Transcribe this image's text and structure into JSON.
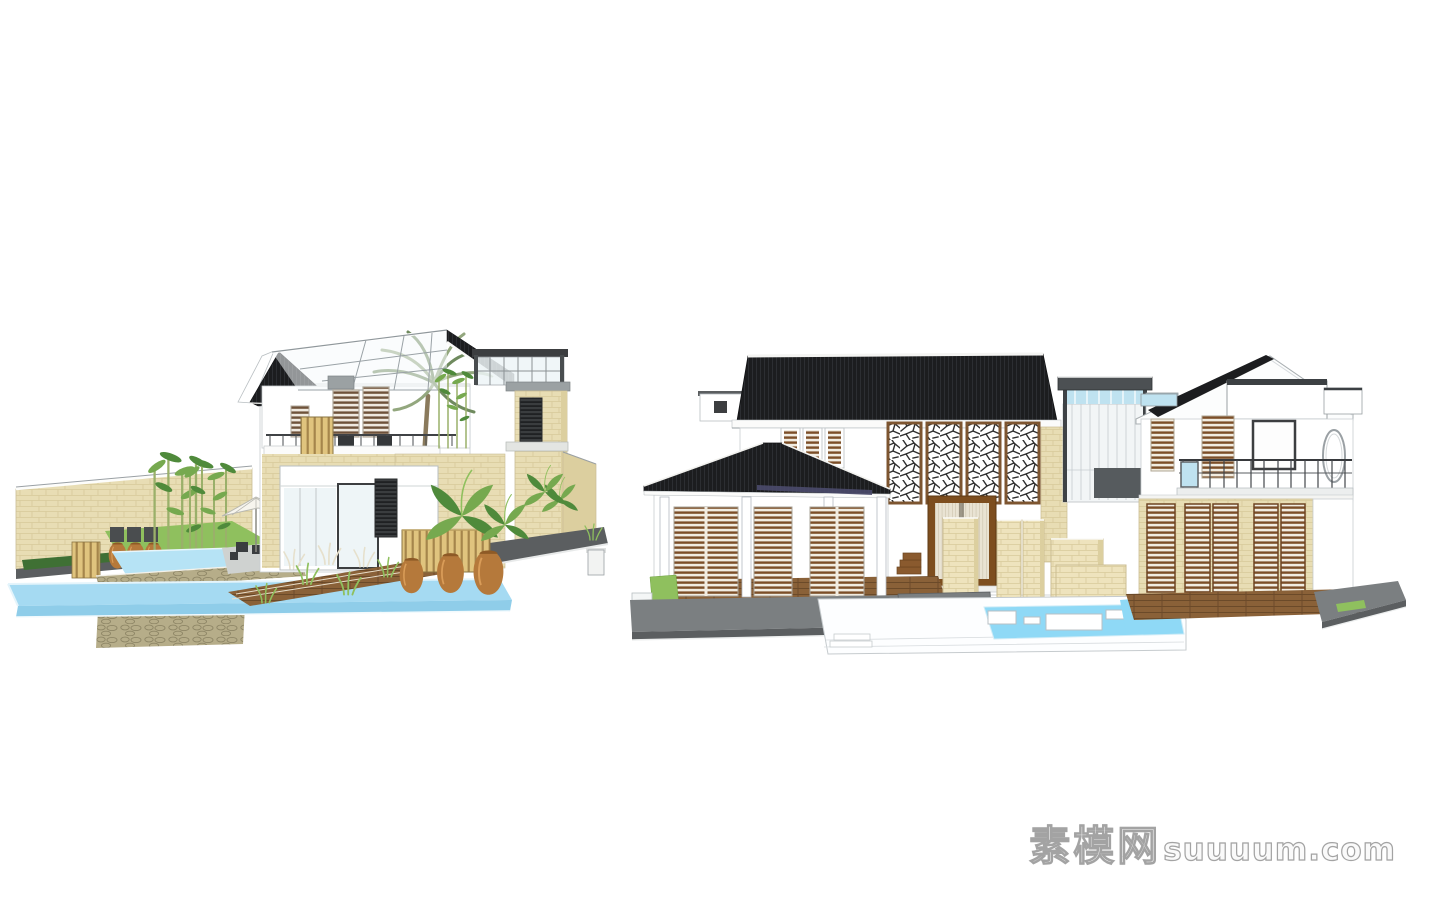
{
  "watermark": {
    "brand_cn": "素模网",
    "site": "suuuum.com"
  },
  "colors": {
    "background": "#ffffff",
    "roof_black": "#1c1d1f",
    "tile_line": "#3a3c40",
    "fascia_white": "#fbfbfa",
    "wall_white": "#ffffff",
    "line_gray": "#9aa0a4",
    "stone_beige": "#e8ddb4",
    "stone_light": "#eee3bd",
    "stone_line": "#d2c494",
    "stone_shade": "#dccf9f",
    "wood_tan": "#e0c47e",
    "wood_tan_dark": "#a5854b",
    "louver_brown": "#7c4e28",
    "louver_bg": "#f1ece1",
    "louver2_bg": "#efe9df",
    "louver2_slat": "#6e523a",
    "louver_dark_bg": "#3a3d3f",
    "louver_dark_slat": "#1f2123",
    "lattice_brown": "#7d5530",
    "lattice_line": "#2f2f2f",
    "door_brown": "#7d4e1f",
    "screen_bg": "#e9e3d3",
    "screen_line": "#bdb298",
    "water_blue": "#a5daf2",
    "water_bright": "#8fd9f6",
    "water_light": "#b6e3f5",
    "water_front": "#8fcde9",
    "water_rim": "#e4f4fb",
    "platform_gray": "#7b7f81",
    "platform_dark": "#5b5e60",
    "curb_white": "#f4f6f6",
    "deck_brown": "#8a6138",
    "deck_line": "#6b4a29",
    "rubble": "#b6ad89",
    "rubble_line": "#8d8565",
    "green_bamboo": "#76a94f",
    "green_dark": "#4f8a3b",
    "green_grass": "#8fc05e",
    "hedge_green": "#3f7034",
    "bamboo_stem": "#9ab06a",
    "reed_white": "#e6e0cc",
    "pot_clay": "#b5793b",
    "pot_shadow": "#8e5a26",
    "pot_highlight": "#d99c58",
    "trunk_tan": "#8a7a5c",
    "palm_green": "#93a77e",
    "palm_dark": "#6f8a5e",
    "glass_sky": "#bfe2f0",
    "glass_pale": "#eef5f7",
    "frame_dark": "#3c3e40",
    "underside_indigo": "#4b4b6b",
    "umbrella_white": "#f7f5ee",
    "terrace_gray": "#cfd2d0",
    "furniture_dark": "#3a3d3f",
    "watermark_fill": "#fafafa",
    "watermark_outline": "#a3a3a3"
  }
}
